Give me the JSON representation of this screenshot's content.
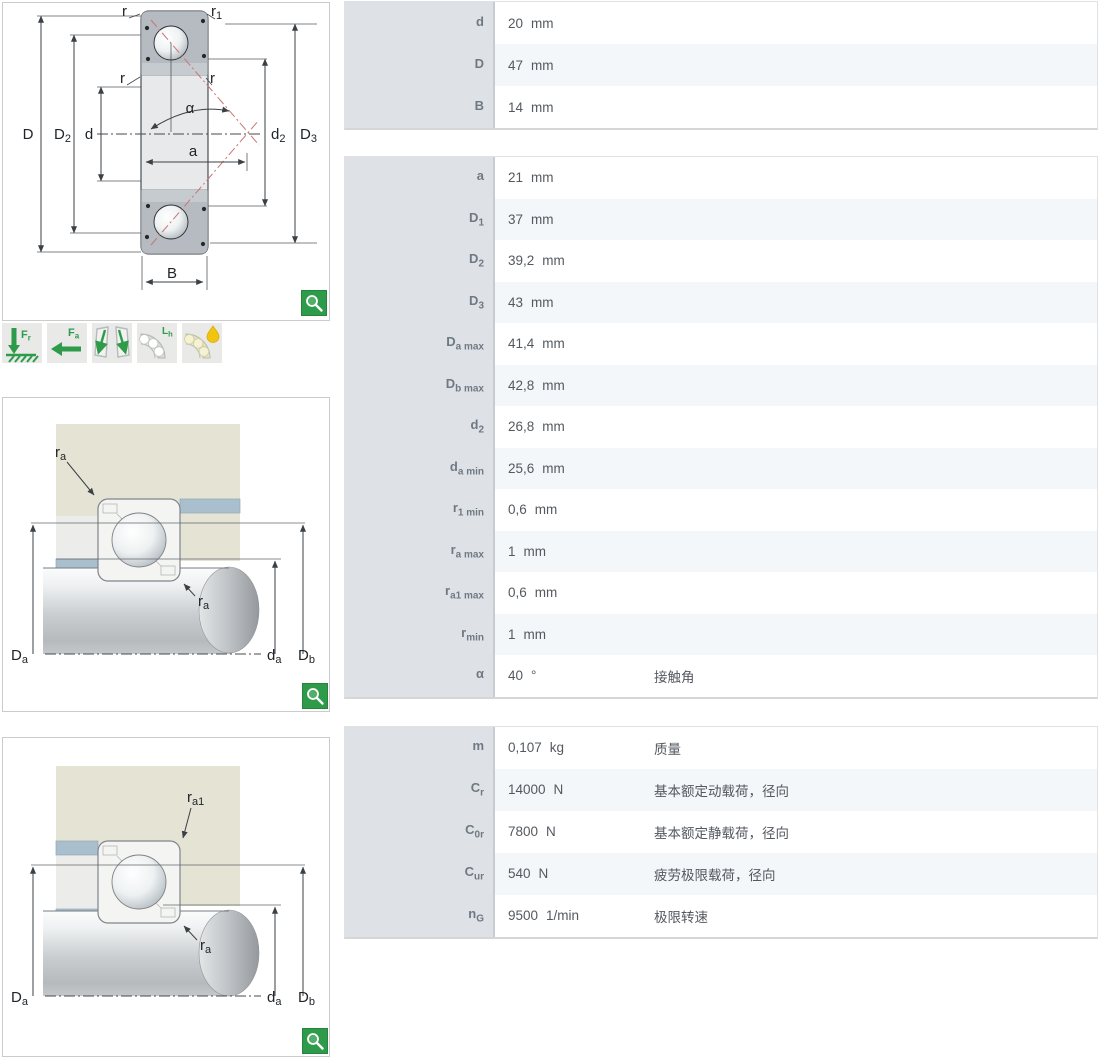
{
  "colors": {
    "accent_green": "#2e9b4b",
    "diagram_red": "#c87474",
    "housing_beige": "#e4e3d4",
    "spacer_blue": "#a9bfcd",
    "label_column_bg": "#dee2e6",
    "alt_row_bg": "#f4f7f9"
  },
  "drawings": {
    "section": {
      "labels": {
        "r_top": "r",
        "r1": "r",
        "r1_sub": "1",
        "r_left": "r",
        "r_right": "r",
        "alpha": "α",
        "D": "D",
        "D2": "D",
        "D2_sub": "2",
        "d": "d",
        "a": "a",
        "d2": "d",
        "d2_sub": "2",
        "D3": "D",
        "D3_sub": "3",
        "B": "B"
      }
    },
    "features": {
      "icons": [
        {
          "name": "radial-load-icon",
          "label": "F",
          "label_sub": "r"
        },
        {
          "name": "axial-load-icon",
          "label": "F",
          "label_sub": "a"
        },
        {
          "name": "angular-misalignment-icon",
          "label": "",
          "label_sub": ""
        },
        {
          "name": "rating-life-icon",
          "label": "L",
          "label_sub": "h"
        },
        {
          "name": "lubrication-icon",
          "label": "",
          "label_sub": ""
        }
      ]
    },
    "mounting_a": {
      "labels": {
        "ra_top": "r",
        "ra_top_sub": "a",
        "ra_mid": "r",
        "ra_mid_sub": "a",
        "Da": "D",
        "Da_sub": "a",
        "da": "d",
        "da_sub": "a",
        "Db": "D",
        "Db_sub": "b"
      }
    },
    "mounting_a1": {
      "labels": {
        "ra1": "r",
        "ra1_sub": "a1",
        "ra_mid": "r",
        "ra_mid_sub": "a",
        "Da": "D",
        "Da_sub": "a",
        "da": "d",
        "da_sub": "a",
        "Db": "D",
        "Db_sub": "b"
      }
    }
  },
  "tables": [
    {
      "rows": [
        {
          "sym": "d",
          "sub": "",
          "value": "20",
          "unit": "mm",
          "desc": ""
        },
        {
          "sym": "D",
          "sub": "",
          "value": "47",
          "unit": "mm",
          "desc": ""
        },
        {
          "sym": "B",
          "sub": "",
          "value": "14",
          "unit": "mm",
          "desc": ""
        }
      ]
    },
    {
      "rows": [
        {
          "sym": "a",
          "sub": "",
          "value": "21",
          "unit": "mm",
          "desc": ""
        },
        {
          "sym": "D",
          "sub": "1",
          "value": "37",
          "unit": "mm",
          "desc": ""
        },
        {
          "sym": "D",
          "sub": "2",
          "value": "39,2",
          "unit": "mm",
          "desc": ""
        },
        {
          "sym": "D",
          "sub": "3",
          "value": "43",
          "unit": "mm",
          "desc": ""
        },
        {
          "sym": "D",
          "sub": "a max",
          "value": "41,4",
          "unit": "mm",
          "desc": ""
        },
        {
          "sym": "D",
          "sub": "b max",
          "value": "42,8",
          "unit": "mm",
          "desc": ""
        },
        {
          "sym": "d",
          "sub": "2",
          "value": "26,8",
          "unit": "mm",
          "desc": ""
        },
        {
          "sym": "d",
          "sub": "a min",
          "value": "25,6",
          "unit": "mm",
          "desc": ""
        },
        {
          "sym": "r",
          "sub": "1 min",
          "value": "0,6",
          "unit": "mm",
          "desc": ""
        },
        {
          "sym": "r",
          "sub": "a max",
          "value": "1",
          "unit": "mm",
          "desc": ""
        },
        {
          "sym": "r",
          "sub": "a1 max",
          "value": "0,6",
          "unit": "mm",
          "desc": ""
        },
        {
          "sym": "r",
          "sub": "min",
          "value": "1",
          "unit": "mm",
          "desc": ""
        },
        {
          "sym": "α",
          "sub": "",
          "value": "40",
          "unit": "°",
          "desc": "接触角"
        }
      ]
    },
    {
      "rows": [
        {
          "sym": "m",
          "sub": "",
          "value": "0,107",
          "unit": "kg",
          "desc": "质量"
        },
        {
          "sym": "C",
          "sub": "r",
          "value": "14000",
          "unit": "N",
          "desc": "基本额定动载荷，径向"
        },
        {
          "sym": "C",
          "sub": "0r",
          "value": "7800",
          "unit": "N",
          "desc": "基本额定静载荷，径向"
        },
        {
          "sym": "C",
          "sub": "ur",
          "value": "540",
          "unit": "N",
          "desc": "疲劳极限载荷，径向"
        },
        {
          "sym": "n",
          "sub": "G",
          "value": "9500",
          "unit": "1/min",
          "desc": "极限转速"
        }
      ]
    }
  ]
}
